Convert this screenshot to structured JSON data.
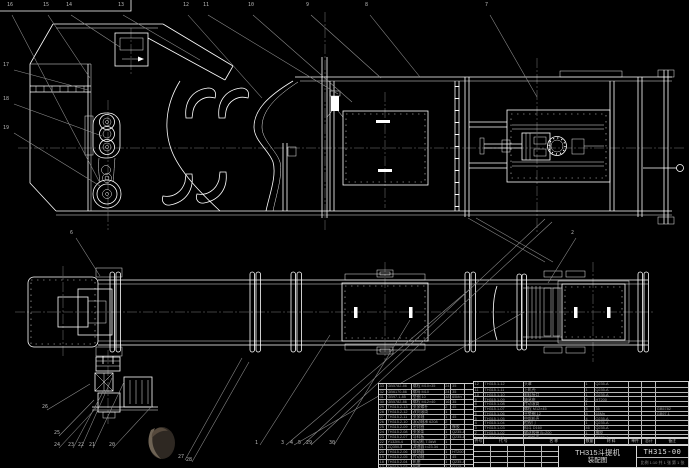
{
  "colors": {
    "background": "#000000",
    "primary_line": "#ffffff",
    "secondary_line": "#8f8f8f",
    "table_line": "#c9c9c9",
    "text": "#9f9f9f"
  },
  "title_block": {
    "product": "TH315斗提机",
    "sheet_name": "装配图",
    "drawing_no": "TH315-00",
    "footer": "比例 1:10  共 1 张  第 1 张"
  },
  "bom_right": {
    "headers": [
      "件号",
      "代  号",
      "名  称",
      "数量",
      "材  料",
      "单件",
      "总计",
      "备注"
    ],
    "rows": [
      [
        "12",
        "TH315.1-12",
        "头罩",
        "1",
        "Q235-A",
        "",
        "",
        ""
      ],
      [
        "11",
        "TH315.1-11",
        "上机壳",
        "1",
        "Q235-A",
        "",
        "",
        ""
      ],
      [
        "10",
        "TH315.1-10",
        "卸料接口",
        "1",
        "Q235-A",
        "",
        "",
        ""
      ],
      [
        "9",
        "TH315.1-09",
        "轴承座",
        "2",
        "HT200",
        "",
        "",
        ""
      ],
      [
        "8",
        "TH315.1-08",
        "传动滚筒",
        "1",
        "",
        "",
        "",
        ""
      ],
      [
        "7",
        "TH315.1-07",
        "螺栓 M12×45",
        "8",
        "35",
        "",
        "",
        "GB5782"
      ],
      [
        "6",
        "TH315.1-06",
        "平垫圈 12",
        "8",
        "65Mn",
        "",
        "",
        "GB97.1"
      ],
      [
        "5",
        "TH315.1-05",
        "中部机壳",
        "4",
        "Q235-A",
        "",
        "",
        ""
      ],
      [
        "4",
        "TH315.1-04",
        "检视门",
        "1",
        "Q235-A",
        "",
        "",
        ""
      ],
      [
        "3",
        "TH315.1-03",
        "料斗 D160",
        "46",
        "Q235-A",
        "",
        "",
        ""
      ],
      [
        "2",
        "TH315.1-02",
        "输送胶带 B=200",
        "1",
        "橡胶",
        "",
        "",
        ""
      ],
      [
        "1",
        "TH315.1-01",
        "下部机壳",
        "1",
        "Q235-A",
        "",
        "",
        ""
      ]
    ]
  },
  "bom_left": {
    "rows": [
      [
        "33",
        "GB5782-86",
        "螺栓 M10×35",
        "24",
        "35",
        ""
      ],
      [
        "32",
        "GB6170-86",
        "螺母 M10",
        "24",
        "35",
        ""
      ],
      [
        "31",
        "GB97.1-85",
        "垫圈 10",
        "48",
        "65Mn",
        ""
      ],
      [
        "30",
        "GB5782-86",
        "螺栓 M12×40",
        "16",
        "35",
        ""
      ],
      [
        "29",
        "TH315.2-13",
        "张紧螺杆",
        "2",
        "45",
        ""
      ],
      [
        "28",
        "TH315.2-12",
        "改向滚筒",
        "1",
        "",
        ""
      ],
      [
        "27",
        "TH315.2-11",
        "张紧轴",
        "1",
        "45",
        ""
      ],
      [
        "26",
        "TH315.2-10",
        "滚动轴承 6208",
        "2",
        "",
        ""
      ],
      [
        "25",
        "TH315.2-09",
        "密封圈",
        "2",
        "橡胶",
        ""
      ],
      [
        "24",
        "TH315.2-08",
        "张紧架",
        "1",
        "Q235-A",
        ""
      ],
      [
        "23",
        "TH315.2-07",
        "导料板",
        "2",
        "Q235-A",
        ""
      ],
      [
        "22",
        "Y132M-4",
        "电动机 7.5kW",
        "1",
        "",
        ""
      ],
      [
        "21",
        "ZQ350-Ⅱ",
        "减速器 i=23.34",
        "1",
        "",
        ""
      ],
      [
        "20",
        "TH315.2-06",
        "联轴器",
        "1",
        "HT200",
        ""
      ],
      [
        "19",
        "TH315.2-05",
        "传动轴",
        "1",
        "45",
        ""
      ],
      [
        "18",
        "TH315.2-04",
        "机座",
        "1",
        "Q235-A",
        ""
      ],
      [
        "17",
        "TH315.2-03",
        "护罩",
        "1",
        "Q215",
        ""
      ]
    ]
  },
  "balloons": [
    {
      "label": "16",
      "x": 7,
      "y": 3
    },
    {
      "label": "15",
      "x": 43,
      "y": 3
    },
    {
      "label": "14",
      "x": 66,
      "y": 3
    },
    {
      "label": "13",
      "x": 118,
      "y": 3
    },
    {
      "label": "12",
      "x": 183,
      "y": 3
    },
    {
      "label": "11",
      "x": 203,
      "y": 3
    },
    {
      "label": "10",
      "x": 248,
      "y": 3
    },
    {
      "label": "9",
      "x": 306,
      "y": 3
    },
    {
      "label": "8",
      "x": 365,
      "y": 3
    },
    {
      "label": "7",
      "x": 485,
      "y": 3
    },
    {
      "label": "17",
      "x": 3,
      "y": 63
    },
    {
      "label": "18",
      "x": 3,
      "y": 97
    },
    {
      "label": "19",
      "x": 3,
      "y": 126
    },
    {
      "label": "6",
      "x": 70,
      "y": 231
    },
    {
      "label": "2",
      "x": 571,
      "y": 231
    },
    {
      "label": "26",
      "x": 42,
      "y": 405
    },
    {
      "label": "25",
      "x": 54,
      "y": 431
    },
    {
      "label": "24",
      "x": 54,
      "y": 443
    },
    {
      "label": "23",
      "x": 68,
      "y": 443
    },
    {
      "label": "22",
      "x": 78,
      "y": 443
    },
    {
      "label": "21",
      "x": 89,
      "y": 443
    },
    {
      "label": "20",
      "x": 109,
      "y": 443
    },
    {
      "label": "27",
      "x": 178,
      "y": 455
    },
    {
      "label": "28",
      "x": 186,
      "y": 458
    },
    {
      "label": "1",
      "x": 255,
      "y": 441
    },
    {
      "label": "3",
      "x": 281,
      "y": 441
    },
    {
      "label": "4",
      "x": 290,
      "y": 441
    },
    {
      "label": "5",
      "x": 298,
      "y": 441
    },
    {
      "label": "29",
      "x": 306,
      "y": 441
    },
    {
      "label": "30",
      "x": 329,
      "y": 441
    }
  ]
}
